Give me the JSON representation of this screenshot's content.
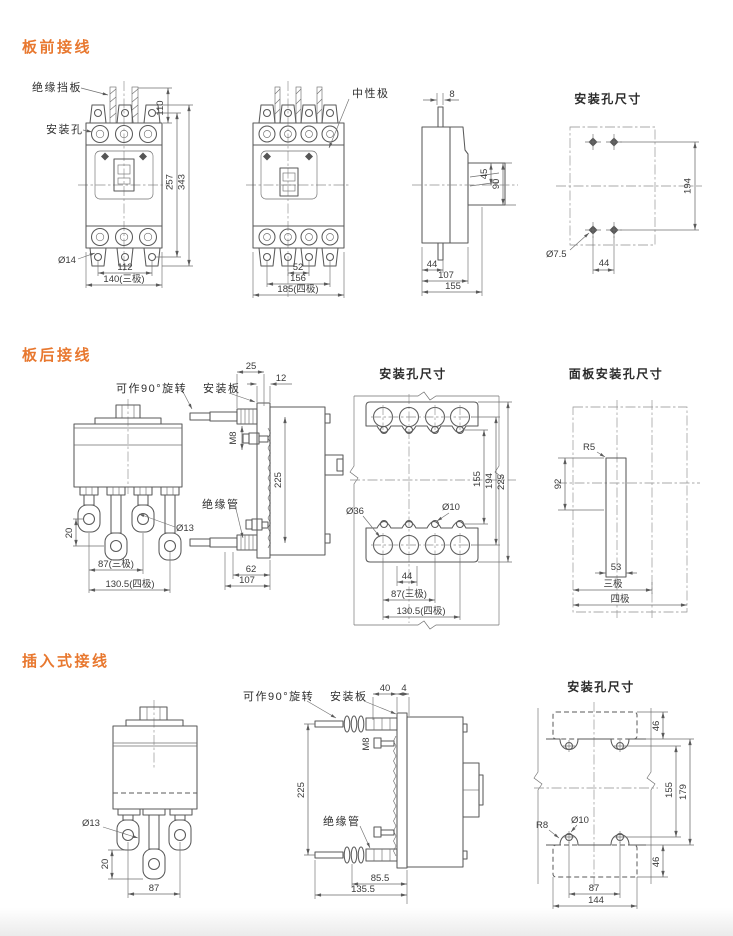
{
  "page": {
    "background": "#ffffff",
    "accent_color": "#e8782f",
    "line_color": "#5a5a5a"
  },
  "sections": [
    {
      "title": "板前接线",
      "front_view_3pole": {
        "insulation_barrier_label": "绝缘挡板",
        "mounting_hole_label": "安装孔",
        "hole_dia": "Ø14",
        "dim_110": "110",
        "dim_257": "257",
        "dim_343": "343",
        "dim_112": "112",
        "dim_140": "140(三极)"
      },
      "front_view_4pole": {
        "neutral_pole_label": "中性极",
        "dim_52": "52",
        "dim_156": "156",
        "dim_185": "185(四极)"
      },
      "side_view": {
        "dim_8": "8",
        "dim_45": "45",
        "dim_90": "90",
        "dim_44": "44",
        "dim_107": "107",
        "dim_155": "155"
      },
      "mounting_holes": {
        "title": "安装孔尺寸",
        "dim_194": "194",
        "hole_dia": "Ø7.5",
        "dim_44": "44"
      }
    },
    {
      "title": "板后接线",
      "rear_view": {
        "rotate_label": "可作90°旋转",
        "stud_dia": "Ø13",
        "dim_20": "20",
        "dim_87": "87(三极)",
        "dim_130_5": "130.5(四极)"
      },
      "side_view": {
        "plate_label": "安装板",
        "bolt_label": "M8",
        "tube_label": "绝缘管",
        "dim_25": "25",
        "dim_12": "12",
        "dim_225": "225",
        "dim_62": "62",
        "dim_107": "107"
      },
      "mounting_holes": {
        "title": "安装孔尺寸",
        "big_hole_dia": "Ø36",
        "small_hole_dia": "Ø10",
        "dim_155": "155",
        "dim_194": "194",
        "dim_225": "225",
        "dim_44": "44",
        "dim_87": "87(三极)",
        "dim_130_5": "130.5(四极)"
      },
      "panel_cutout": {
        "title": "面板安装孔尺寸",
        "radius": "R5",
        "dim_92": "92",
        "dim_53": "53",
        "three_pole": "三极",
        "four_pole": "四极"
      }
    },
    {
      "title": "插入式接线",
      "front_view": {
        "stud_dia": "Ø13",
        "dim_20": "20",
        "dim_87": "87"
      },
      "side_view": {
        "rotate_label": "可作90°旋转",
        "plate_label": "安装板",
        "bolt_label": "M8",
        "tube_label": "绝缘管",
        "dim_40": "40",
        "dim_4": "4",
        "dim_225": "225",
        "dim_85_5": "85.5",
        "dim_135_5": "135.5"
      },
      "mounting_holes": {
        "title": "安装孔尺寸",
        "radius": "R8",
        "hole_dia": "Ø10",
        "dim_46_top": "46",
        "dim_155": "155",
        "dim_179": "179",
        "dim_46_bottom": "46",
        "dim_87": "87",
        "dim_144": "144"
      }
    }
  ]
}
